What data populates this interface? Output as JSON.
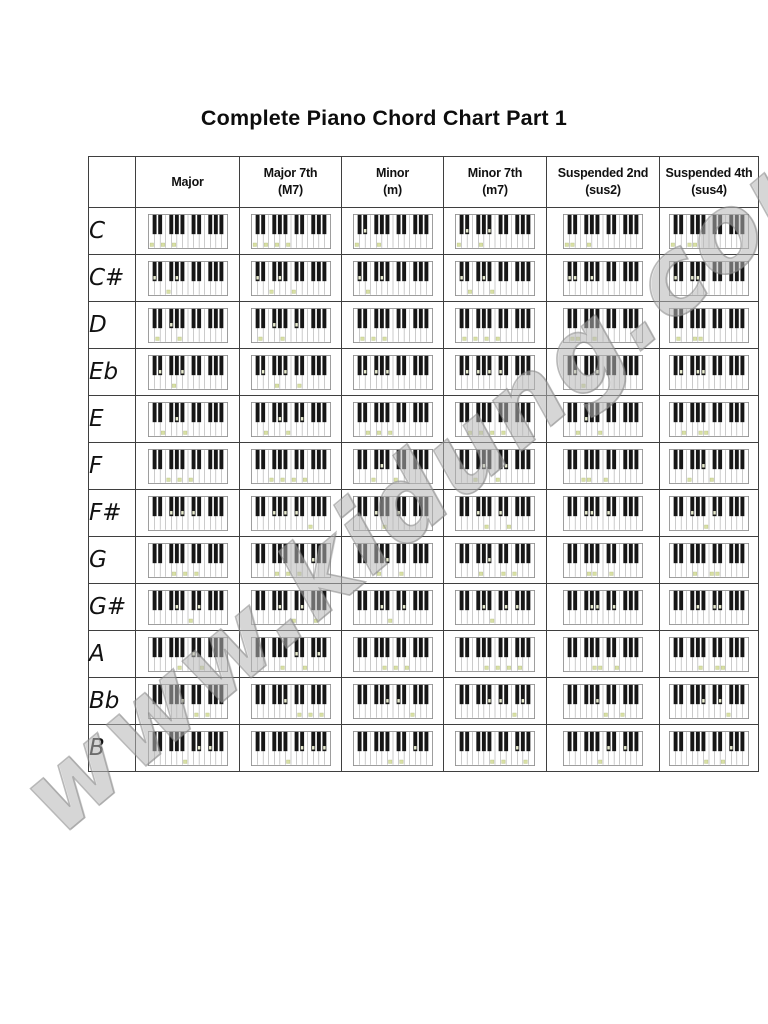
{
  "page": {
    "title": "Complete Piano Chord Chart Part 1",
    "watermark": "www.kidung.com"
  },
  "table": {
    "corner_label": "",
    "columns": [
      {
        "label": "Major",
        "sublabel": "",
        "intervals": [
          0,
          4,
          7
        ]
      },
      {
        "label": "Major 7th",
        "sublabel": "(M7)",
        "intervals": [
          0,
          4,
          7,
          11
        ]
      },
      {
        "label": "Minor",
        "sublabel": "(m)",
        "intervals": [
          0,
          3,
          7
        ]
      },
      {
        "label": "Minor 7th",
        "sublabel": "(m7)",
        "intervals": [
          0,
          3,
          7,
          10
        ]
      },
      {
        "label": "Suspended 2nd",
        "sublabel": "(sus2)",
        "intervals": [
          0,
          2,
          7
        ]
      },
      {
        "label": "Suspended 4th",
        "sublabel": "(sus4)",
        "intervals": [
          0,
          5,
          7
        ]
      }
    ],
    "rows": [
      {
        "root": "C",
        "semitone": 0
      },
      {
        "root": "C#",
        "semitone": 1
      },
      {
        "root": "D",
        "semitone": 2
      },
      {
        "root": "Eb",
        "semitone": 3
      },
      {
        "root": "E",
        "semitone": 4
      },
      {
        "root": "F",
        "semitone": 5
      },
      {
        "root": "F#",
        "semitone": 6
      },
      {
        "root": "G",
        "semitone": 7
      },
      {
        "root": "G#",
        "semitone": 8
      },
      {
        "root": "A",
        "semitone": 9
      },
      {
        "root": "Bb",
        "semitone": 10
      },
      {
        "root": "B",
        "semitone": 11
      }
    ],
    "keyboard": {
      "octaves": 2,
      "white_keys": 14,
      "black_keys": 10
    }
  },
  "colors": {
    "table_border": "#3f3f3f",
    "keyboard_border": "#8a8a8a",
    "key_separator": "#9a9a9a",
    "black_key": "#161616",
    "white_key_mark": "#d9e0a4",
    "white_key_mark_edge": "#a9b573",
    "black_key_mark": "#e9ecd0",
    "watermark_gray": "#b9b9b9"
  }
}
